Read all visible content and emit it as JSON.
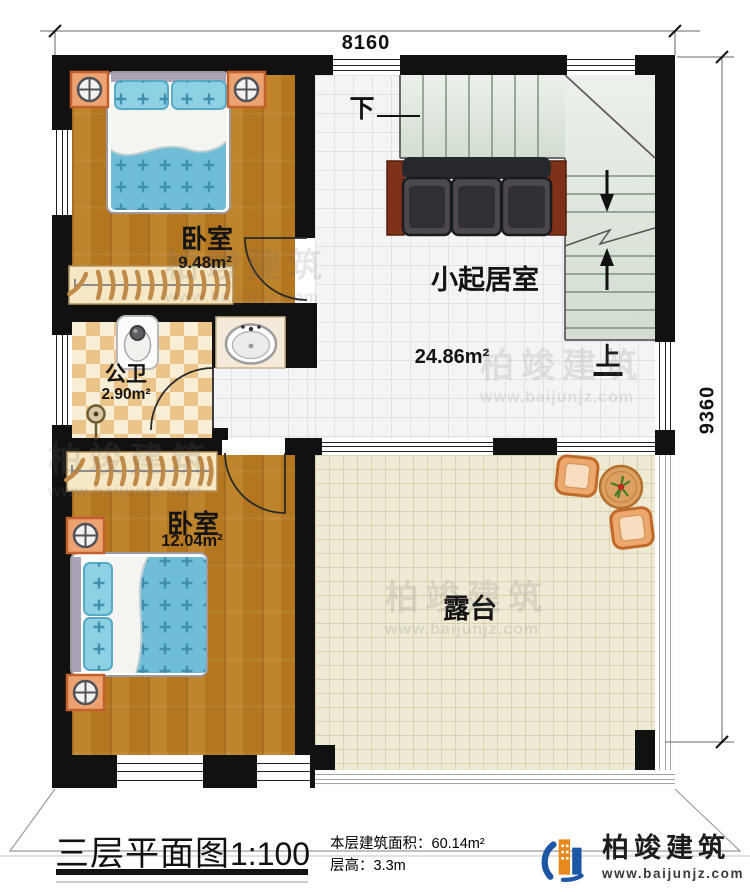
{
  "plan": {
    "dim_top": "8160",
    "dim_right": "9360",
    "rooms": {
      "bedroom1": {
        "name": "卧室",
        "area": "9.48m²"
      },
      "living": {
        "name": "小起居室",
        "area": "24.86m²"
      },
      "bathroom": {
        "name": "公卫",
        "area": "2.90m²"
      },
      "bedroom2": {
        "name": "卧室",
        "area": "12.04m²"
      },
      "terrace": {
        "name": "露台"
      }
    },
    "stairs": {
      "down": "下",
      "up": "上"
    }
  },
  "title_block": {
    "title": "三层平面图",
    "scale": "1:100",
    "area_line": "本层建筑面积：60.14m²",
    "height_line": "层高：3.3m"
  },
  "logo": {
    "company": "柏竣建筑",
    "website": "www.baijunjz.com"
  },
  "watermark": {
    "company": "柏竣建筑",
    "website": "www.baijunjz.com"
  },
  "colors": {
    "wall": "#111111",
    "wood": "#b4761e",
    "bed_blue": "#6fbdd6",
    "tile": "#f4f4f6",
    "terrace": "#eeead3",
    "checker": "#eac488",
    "stair": "#dde5da",
    "sofa_side": "#7e3018",
    "logo_blue": "#1b57a5",
    "logo_orange": "#e8891d"
  }
}
